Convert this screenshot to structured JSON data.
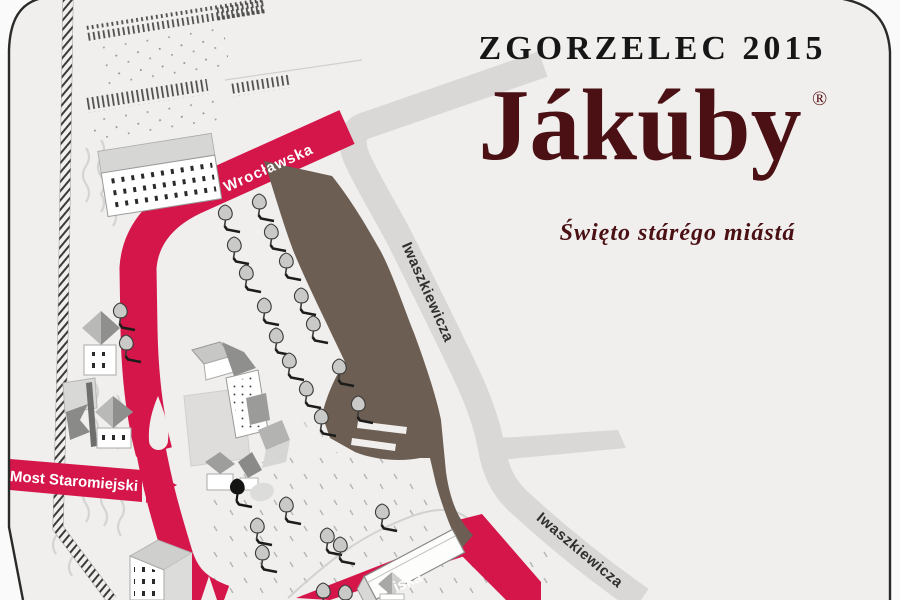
{
  "poster": {
    "event_title": "ZGORZELEC 2015",
    "logo_text": "Jákúby",
    "registered_mark": "®",
    "subtitle": "Święto stárégo miástá"
  },
  "map": {
    "street_labels": {
      "wroclawska": "Wrocławska",
      "most_staromiejski": "Most Staromiejski",
      "iwaszkiewicza_north": "Iwaszkiewicza",
      "iwaszkiewicza_south": "Iwaszkiewicza",
      "bottom_street_partial": "iska"
    },
    "colors": {
      "festival_route_red": "#d4164a",
      "promenade_brown": "#6d5e53",
      "road_gray": "#d9d8d6",
      "sheet_background": "#f0efed",
      "outside_background": "#fafafa",
      "logo_maroon": "#4a1014",
      "title_black": "#161616"
    },
    "icons": {
      "tree": "deciduous-tree-icon",
      "black_tree": "black-tree-silhouette-icon",
      "water_ripples": "water-ripple-icon",
      "hatched_border": "river-bank-hatch-icon",
      "buildings": "isometric-building-icon"
    }
  }
}
